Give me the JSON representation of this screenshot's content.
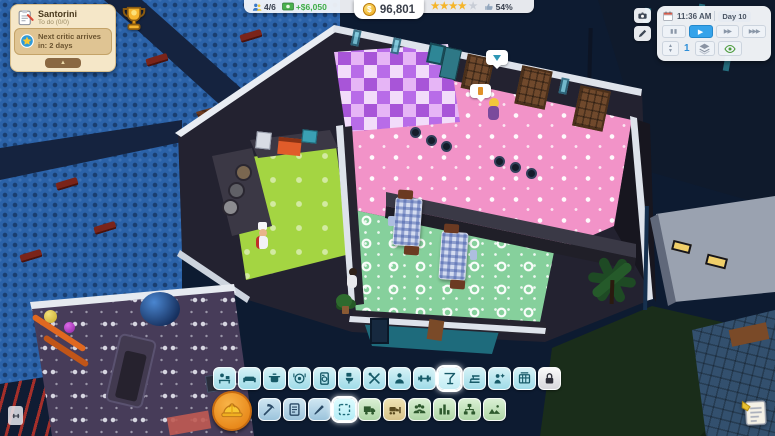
{
  "colors": {
    "toolbar_cyan": "#aee0ec",
    "builder_orange": "#f59a23",
    "money_green": "#3fae49",
    "star_gold": "#f5b52a"
  },
  "hud": {
    "quest_panel": {
      "title": "Santorini",
      "subtitle": "To do (0/0)",
      "notification": "Next critic arrives in: 2 days",
      "collapse_glyph": "▲"
    },
    "stats_bar": {
      "capacity": "4/6",
      "profit": "+$6,050",
      "currency_symbol": "$",
      "money": "96,801",
      "stars_filled_glyphs": "★★★★",
      "stars_empty_glyphs": "★",
      "satisfaction": "54%"
    },
    "time_panel": {
      "time": "11:36 AM",
      "day": "Day 10",
      "floor_number": "1",
      "floor_up_glyph": "▲",
      "floor_down_glyph": "▼",
      "controls": [
        {
          "name": "pause",
          "glyph": "▮▮"
        },
        {
          "name": "play",
          "glyph": "▶"
        },
        {
          "name": "fast-forward",
          "glyph": "▶▶"
        },
        {
          "name": "fastest-forward",
          "glyph": "▶▶▶"
        }
      ]
    },
    "side_buttons": [
      {
        "name": "screenshot-camera"
      },
      {
        "name": "edit-pen"
      }
    ]
  },
  "toolbar_rooms": {
    "items": [
      {
        "name": "front-desk"
      },
      {
        "name": "lounge-sofa"
      },
      {
        "name": "kitchen-pot"
      },
      {
        "name": "dining-plate"
      },
      {
        "name": "appliance-fridge"
      },
      {
        "name": "bathroom-toilet"
      },
      {
        "name": "utilities-tools"
      },
      {
        "name": "staff-room"
      },
      {
        "name": "gym-dumbbell"
      },
      {
        "name": "bar-cocktail",
        "selected": true
      },
      {
        "name": "audience-seats"
      },
      {
        "name": "spa-person"
      },
      {
        "name": "arcade-machines"
      },
      {
        "name": "locked-slot",
        "locked": true
      }
    ]
  },
  "toolbar_build": {
    "items": [
      {
        "name": "demolish-pickaxe"
      },
      {
        "name": "blueprint-plan"
      },
      {
        "name": "paint-brush"
      },
      {
        "name": "select-marquee",
        "selected": true
      },
      {
        "name": "delivery-truck"
      },
      {
        "name": "bulldozer"
      },
      {
        "name": "staff-group"
      },
      {
        "name": "business-stats"
      },
      {
        "name": "org-chart"
      },
      {
        "name": "terrain-rocks"
      }
    ]
  },
  "corner_buttons": {
    "builder": "hard-hat",
    "notes": "notepad"
  }
}
